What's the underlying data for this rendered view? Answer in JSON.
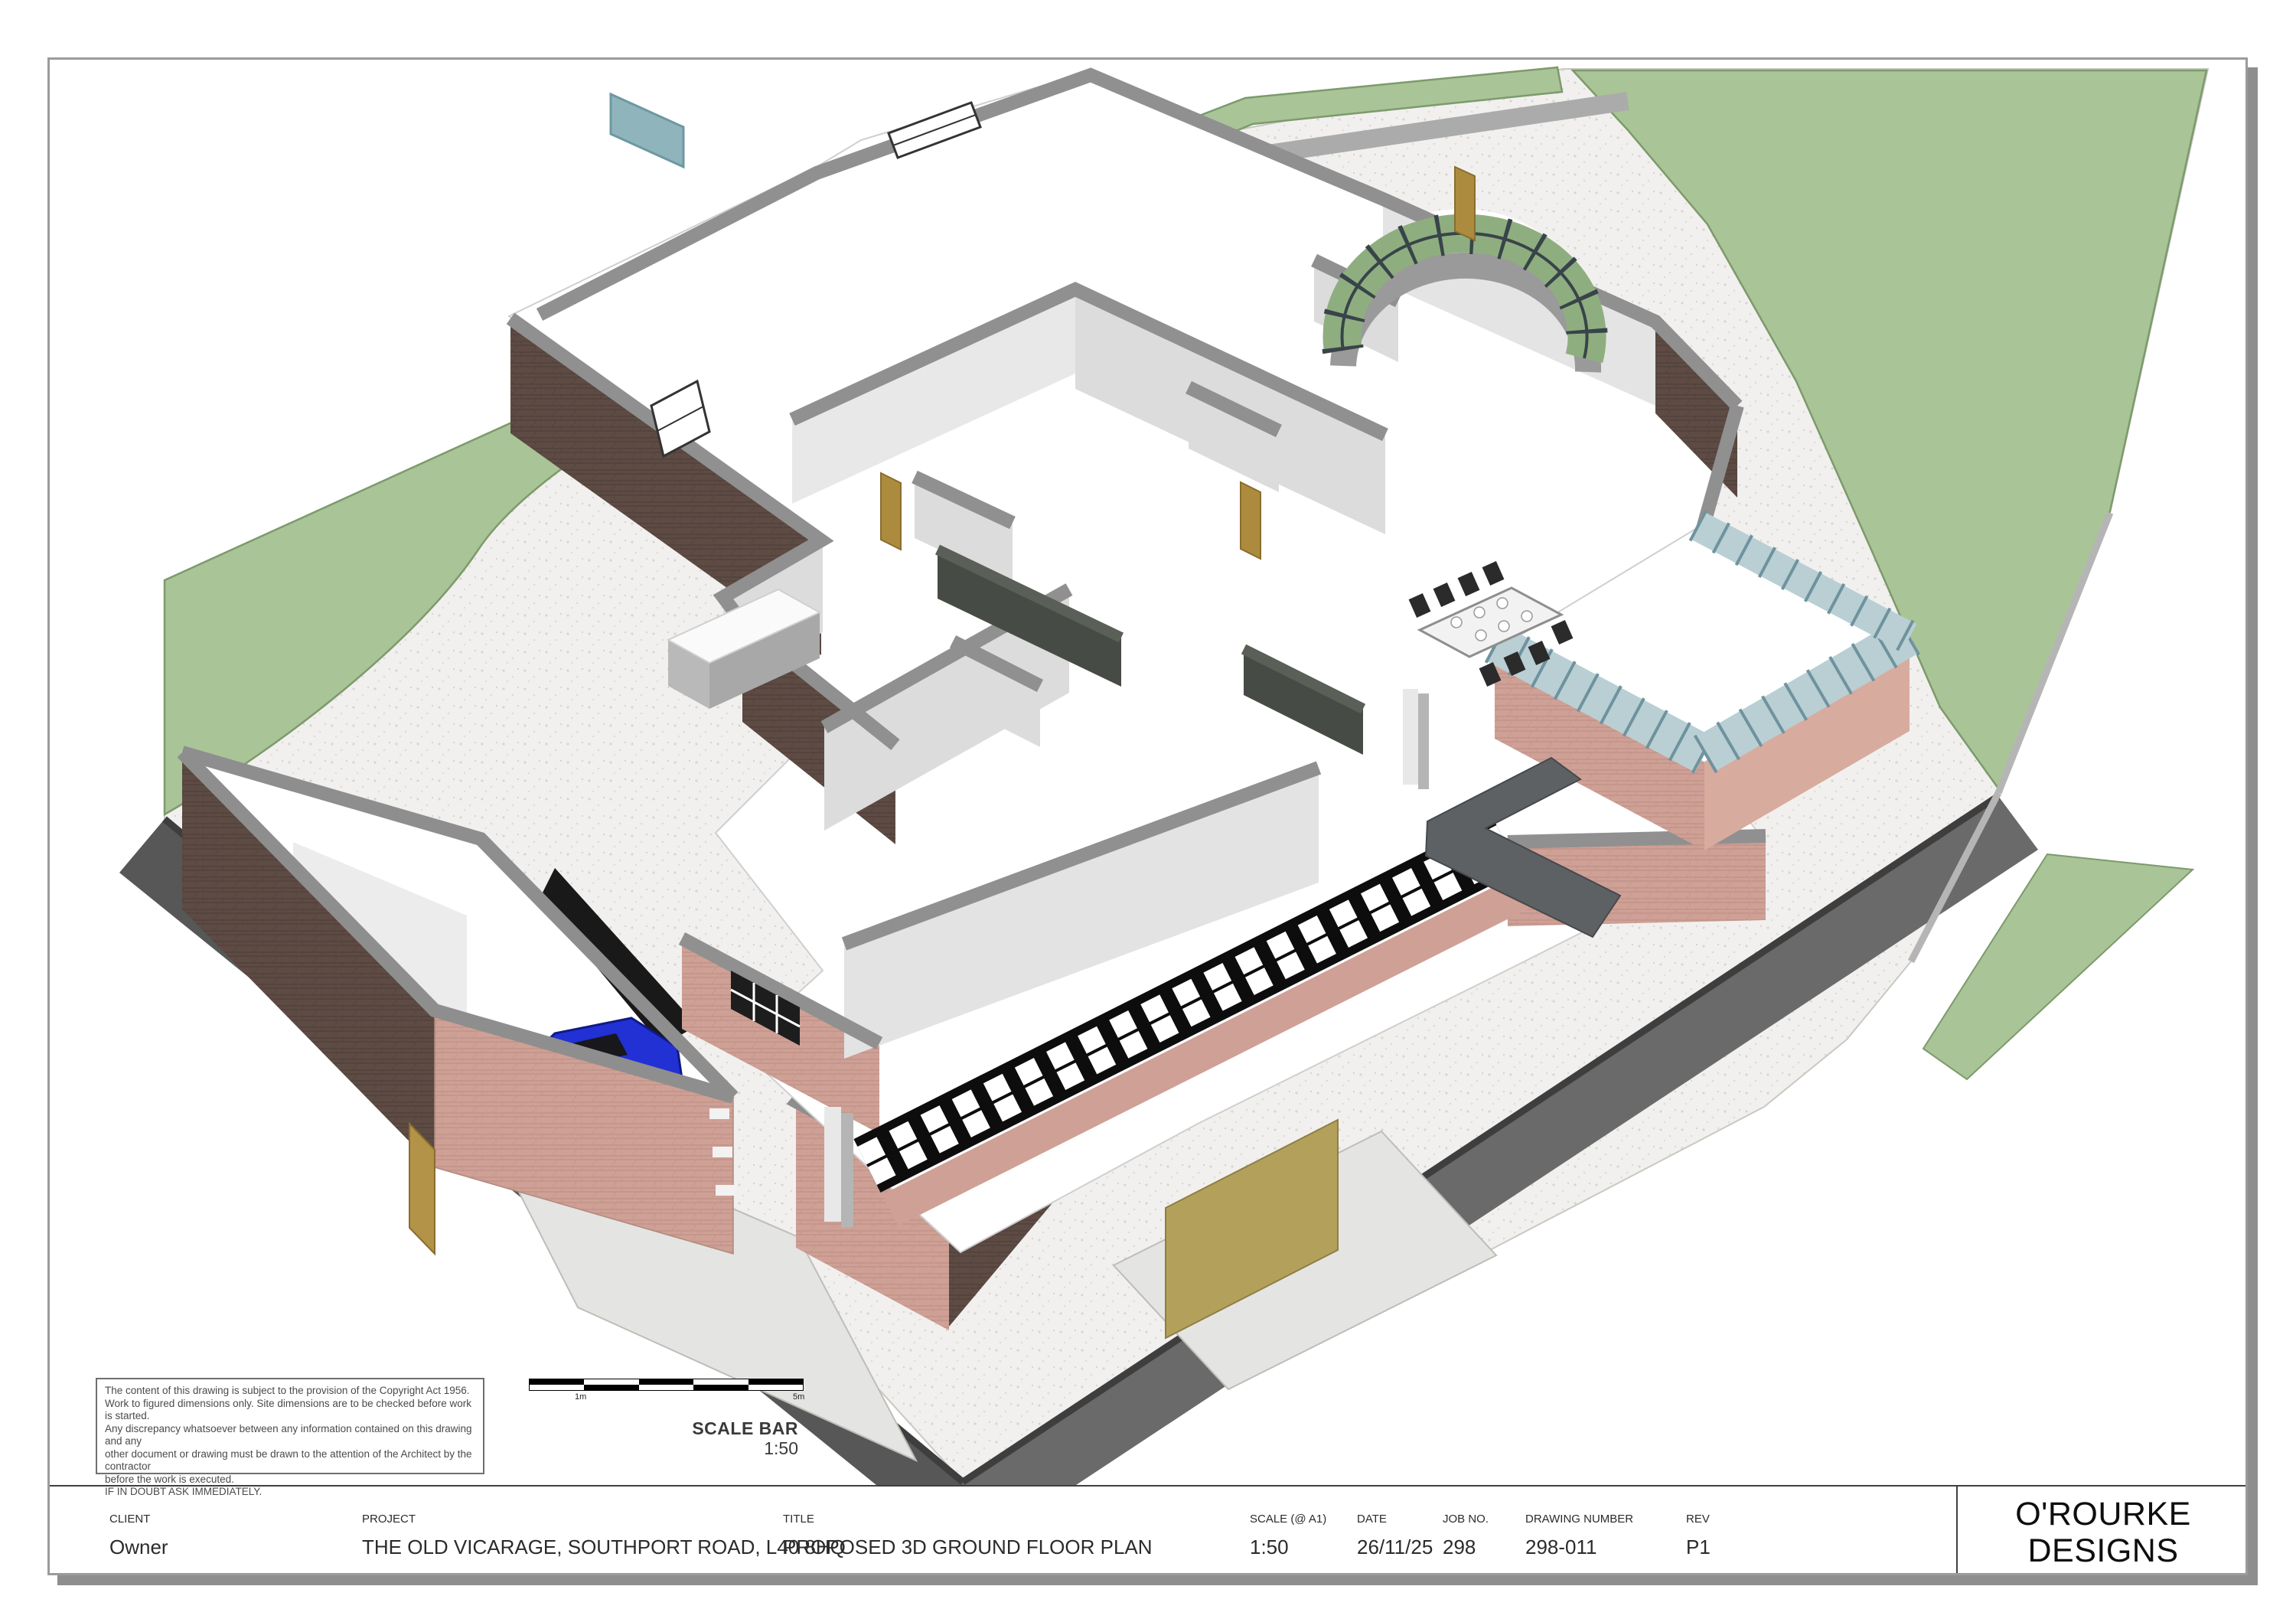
{
  "drawing_view": {
    "type": "3D axonometric cutaway ground floor plan",
    "elements": [
      "grass-bank",
      "lawn",
      "speckled-paved-driveway",
      "access-road",
      "concrete-apron",
      "garage-block-with-blue-car",
      "walled-courtyard",
      "curved-garden-hedges",
      "main-house-brick-cutaway",
      "curved-glazed-bay",
      "garden-room-glazing",
      "black-bifold-glazed-doors",
      "dining-table-with-chairs",
      "kitchen-island",
      "kitchen-cabinets",
      "corner-sofa",
      "timber-doors",
      "timber-fence"
    ],
    "palette": {
      "paper": "#ffffff",
      "page_border": "#9b9b9b",
      "page_shadow": "#8e8e8e",
      "grass": "#a9c497",
      "grass_edge": "#7d9a6c",
      "hedge_light": "#9fb98e",
      "hedge_dark": "#5f7054",
      "paving": "#f1f0ee",
      "paving_speck": "#d7d6d1",
      "concrete": "#e4e4e2",
      "road_dark": "#575757",
      "road_mid": "#6a6a6a",
      "kerb": "#b5b5b5",
      "brick_dark": "#5d4b44",
      "brick_pink": "#cfa096",
      "wall_cap": "#909090",
      "wall_light": "#dcdcdc",
      "floor": "#ffffff",
      "frame_dark": "#384449",
      "frame_teal": "#6f939e",
      "glass_teal": "#b9cfd4",
      "door_tan": "#ad8b3e",
      "fence_tan": "#b3a05b",
      "sofa": "#5d6164",
      "cabinet": "#474b45",
      "car_blue": "#2231d4",
      "rooflight_blue": "#8fb4bc"
    }
  },
  "copyright_box": {
    "lines": [
      "The content of this drawing is subject to the provision of the Copyright Act 1956.",
      "Work to figured dimensions only. Site dimensions are to be checked before work is started.",
      "Any discrepancy whatsoever between any information contained on this drawing and any",
      "other document or drawing must be drawn to the attention of the Architect by the contractor",
      "before the work is executed.",
      "IF IN DOUBT ASK IMMEDIATELY."
    ]
  },
  "scale_bar": {
    "title": "SCALE BAR",
    "ratio": "1:50",
    "tick_1m": "1m",
    "tick_5m": "5m"
  },
  "title_block": {
    "client": {
      "label": "CLIENT",
      "value": "Owner"
    },
    "project": {
      "label": "PROJECT",
      "value": "THE OLD VICARAGE, SOUTHPORT ROAD, L40 8HQ"
    },
    "title": {
      "label": "TITLE",
      "value": "PROPOSED 3D GROUND FLOOR PLAN"
    },
    "scale": {
      "label": "SCALE (@ A1)",
      "value": "1:50"
    },
    "date": {
      "label": "DATE",
      "value": "26/11/25"
    },
    "job_no": {
      "label": "JOB NO.",
      "value": "298"
    },
    "drawing_number": {
      "label": "DRAWING NUMBER",
      "value": "298-011"
    },
    "rev": {
      "label": "REV",
      "value": "P1"
    },
    "logo_line1": "O'ROURKE",
    "logo_line2": "DESIGNS"
  }
}
